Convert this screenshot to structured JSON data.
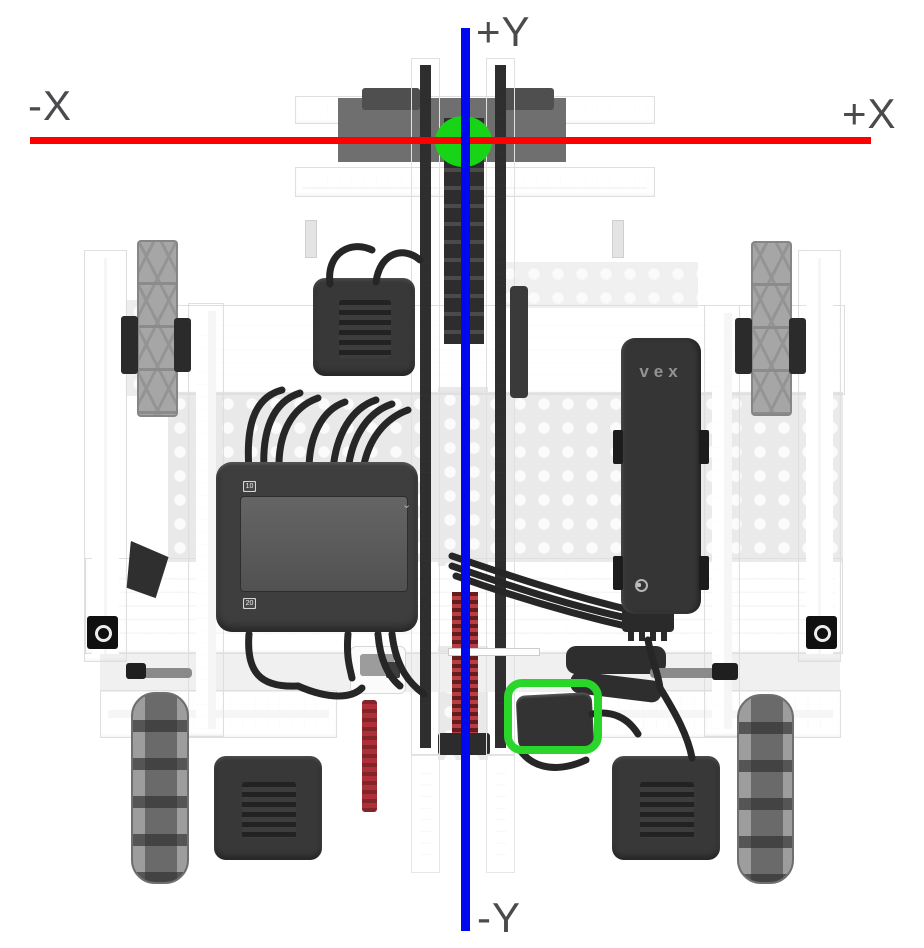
{
  "scene": {
    "description": "Top-down view of a VEX V5 robot with field coordinate axes overlaid",
    "origin_marker": "origin of robot coordinate system",
    "highlighted_component": "sensor highlighted by green box"
  },
  "axes": {
    "labels": {
      "pos_y": "+Y",
      "neg_y": "-Y",
      "pos_x": "+X",
      "neg_x": "-X"
    },
    "colors": {
      "x_axis": "#fe0000",
      "y_axis": "#0009ee",
      "origin_marker": "#17d417",
      "highlight_box": "#2bd62b",
      "label_text": "#4b4b4e"
    }
  },
  "robot": {
    "brain": {
      "top_ports": [
        "1",
        "2",
        "3",
        "4",
        "5",
        "6",
        "7",
        "8",
        "9",
        "10"
      ],
      "bottom_ports": [
        "11",
        "12",
        "13",
        "14",
        "15",
        "16",
        "17",
        "18",
        "19",
        "20"
      ],
      "chevron": "⌄"
    },
    "battery": {
      "logo": "VEX"
    }
  }
}
